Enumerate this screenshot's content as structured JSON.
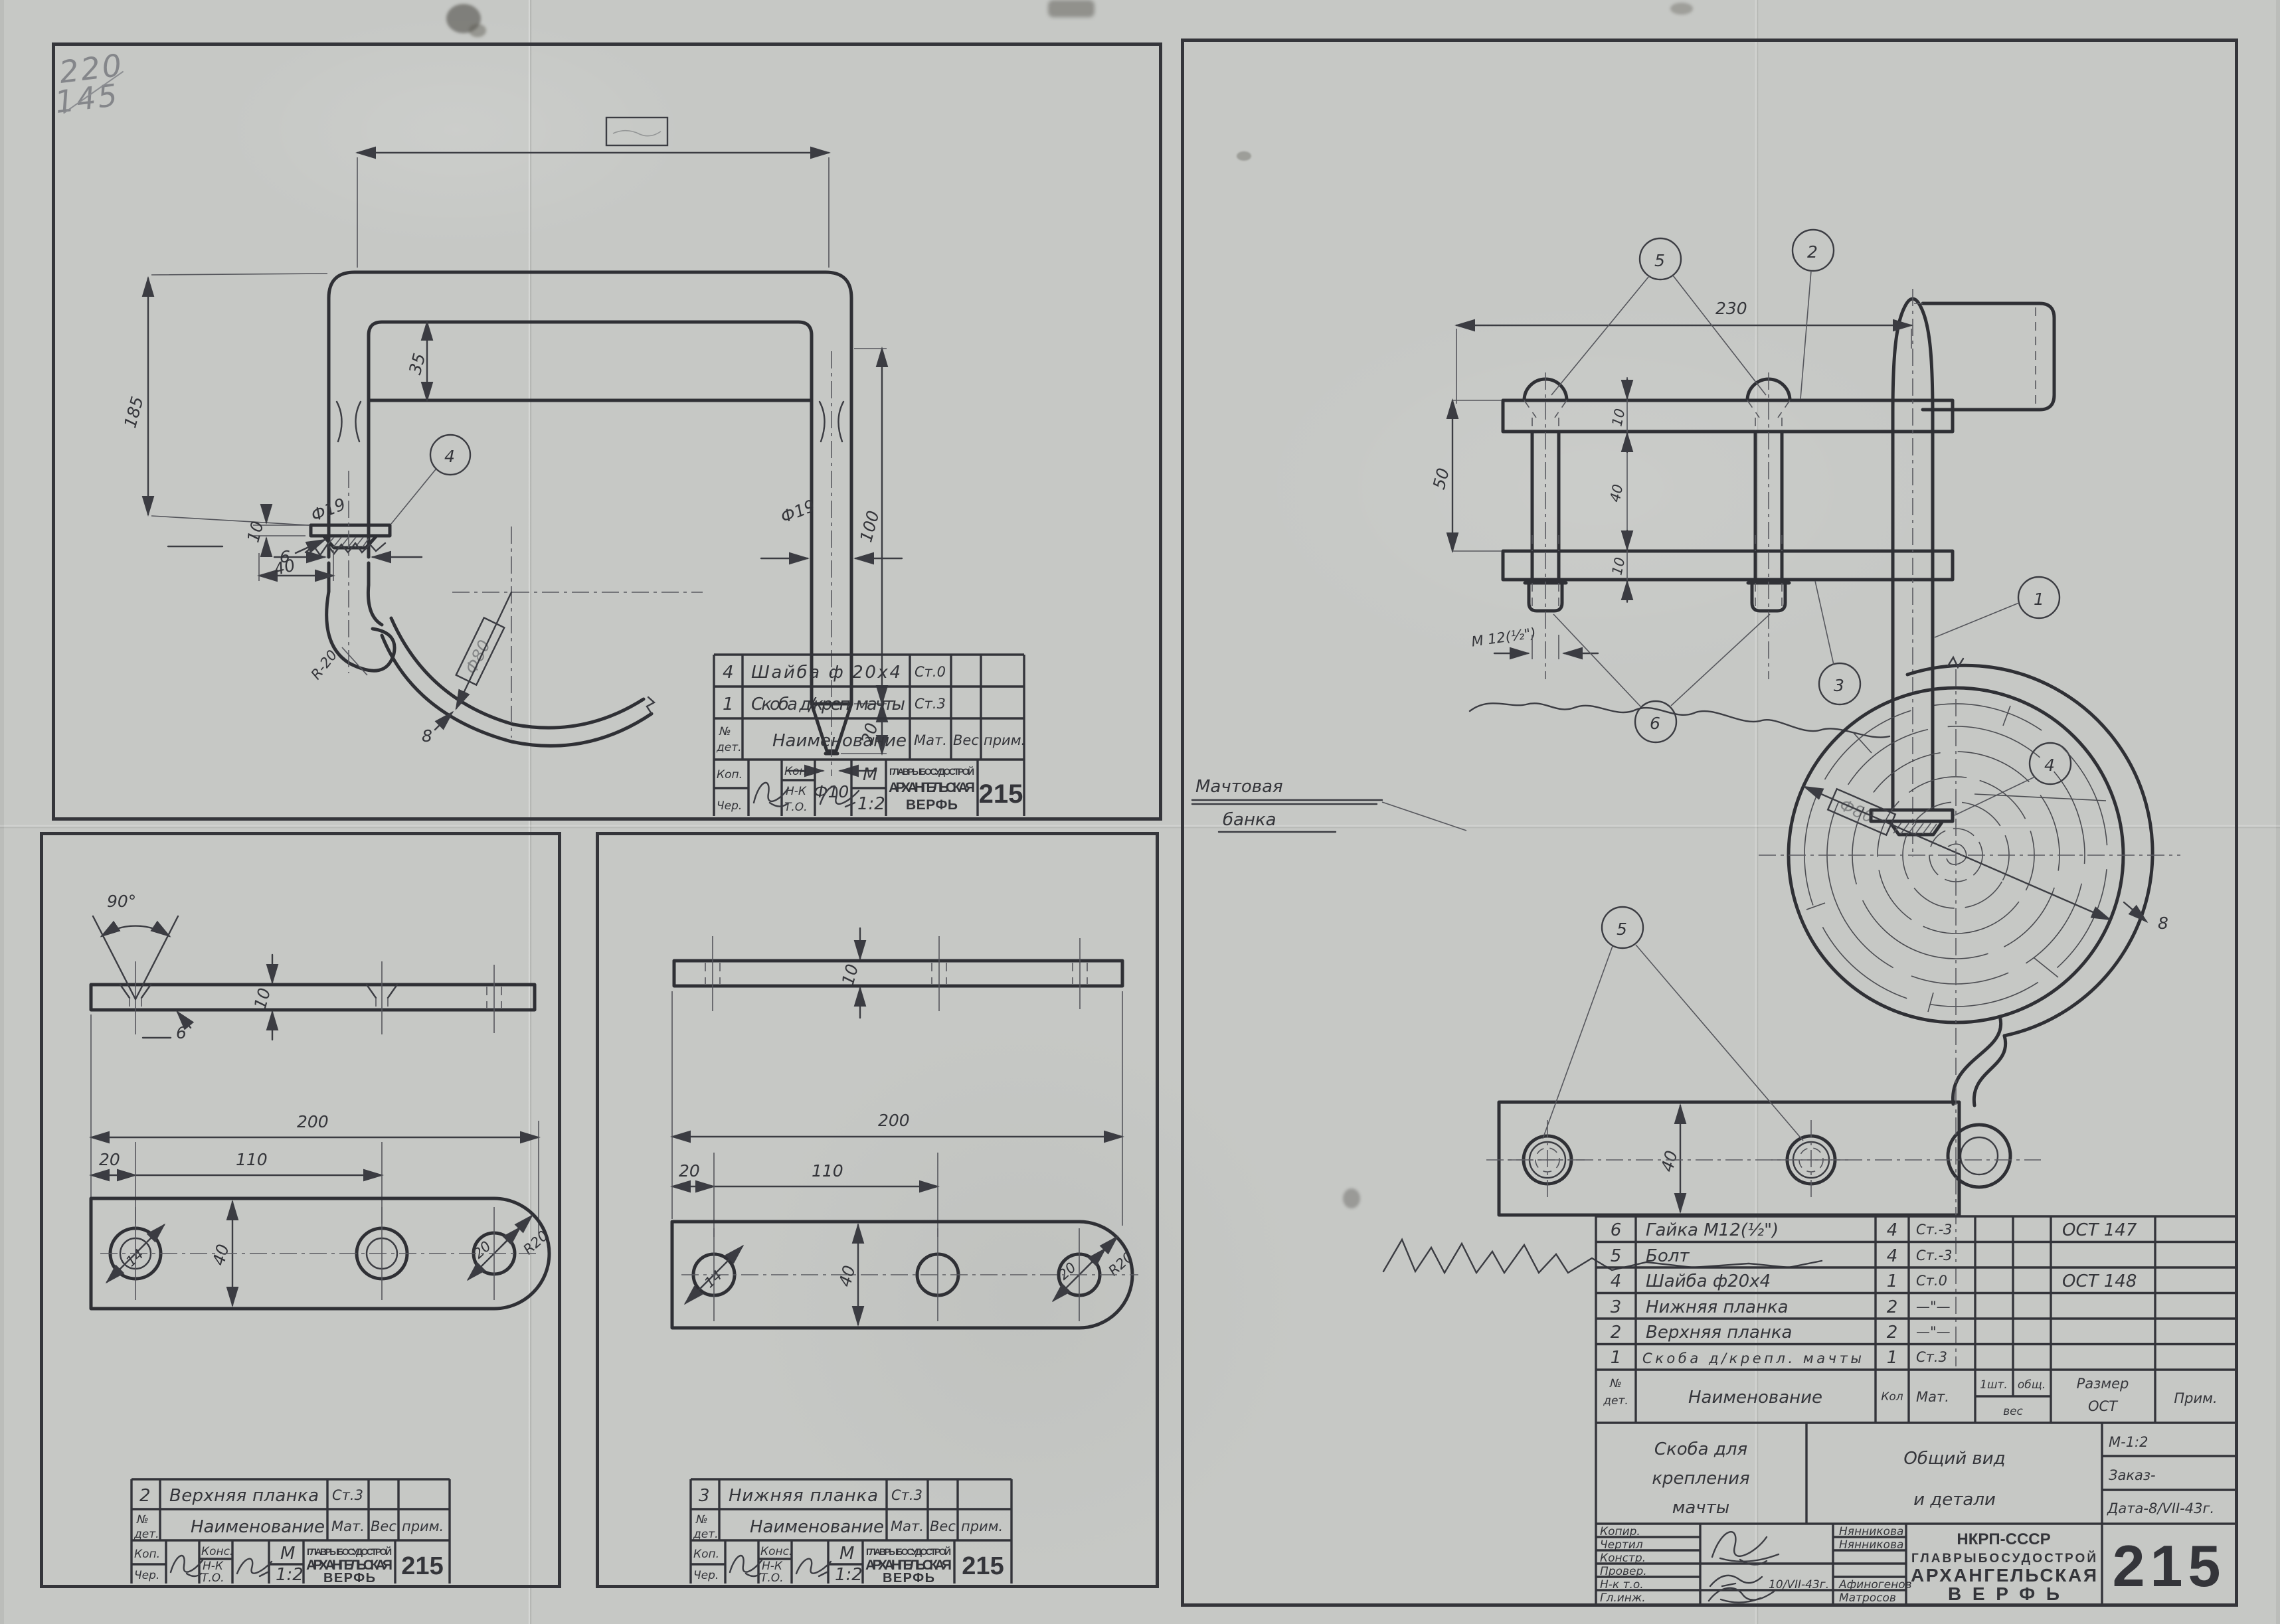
{
  "pencil_note": {
    "line1": "220",
    "line2": "145"
  },
  "small_stamp": {
    "header": {
      "no1": "№",
      "no2": "дет.",
      "name": "Наименование",
      "mat": "Мат.",
      "ves": "Вес",
      "prim": "прим."
    },
    "kop": "Коп.",
    "cher": "Чер.",
    "kon": "Кон.",
    "kons": "Конс.",
    "nk": "Н-К",
    "to": "Т.О.",
    "m": "М",
    "scale": "1:2",
    "org1": "ГЛАВРЫБОСУДОСТРОЙ",
    "org2": "АРХАНГЕЛЬСКАЯ",
    "org3": "ВЕРФЬ",
    "number": "215"
  },
  "tl": {
    "parts": [
      {
        "no": "4",
        "name": "Шайба ф 20х4",
        "mat": "Ст.0"
      },
      {
        "no": "1",
        "name": "Скоба д/креп. мачты",
        "mat": "Ст.3"
      }
    ],
    "balloon4": "4",
    "dims": {
      "span": "",
      "bar": "35",
      "leg": "185",
      "right": "100",
      "tip": "20",
      "tip_dia": "Ф10",
      "dia_l": "Ф19",
      "dia_r": "Ф19",
      "washer": "10",
      "cone": "6",
      "hook_w": "40",
      "hook_r": "R-20",
      "band_dia": "Ф80",
      "band_t": "8"
    }
  },
  "bl": {
    "part": {
      "no": "2",
      "name": "Верхняя планка",
      "mat": "Ст.3"
    },
    "dims": {
      "angle": "90°",
      "t": "10",
      "depth": "6",
      "len": "200",
      "off": "20",
      "pitch": "110",
      "width": "40",
      "hole": "14",
      "end": "20",
      "radius": "R20"
    }
  },
  "bm": {
    "part": {
      "no": "3",
      "name": "Нижняя планка",
      "mat": "Ст.3"
    },
    "dims": {
      "t": "10",
      "len": "200",
      "off": "20",
      "pitch": "110",
      "width": "40",
      "hole": "14",
      "end": "20",
      "radius": "R20"
    }
  },
  "rt": {
    "mast_label1": "Мачтовая",
    "mast_label2": "банка",
    "balloons": {
      "b1": "1",
      "b2": "2",
      "b3": "3",
      "b4": "4",
      "b5": "5",
      "b6": "6"
    },
    "dims": {
      "span": "230",
      "h": "50",
      "t1": "10",
      "gap": "40",
      "t2": "10",
      "thread": "М 12(½\")",
      "width": "40",
      "dia": "Ф80",
      "band": "8"
    },
    "parts": [
      {
        "no": "6",
        "name": "Гайка М12(½\")",
        "qty": "4",
        "mat": "Ст.-3",
        "ost": "ОСТ 147"
      },
      {
        "no": "5",
        "name": "Болт",
        "qty": "4",
        "mat": "Ст.-3",
        "ost": ""
      },
      {
        "no": "4",
        "name": "Шайба ф20х4",
        "qty": "1",
        "mat": "Ст.0",
        "ost": "ОСТ 148"
      },
      {
        "no": "3",
        "name": "Нижняя планка",
        "qty": "2",
        "mat": "—\"—",
        "ost": ""
      },
      {
        "no": "2",
        "name": "Верхняя планка",
        "qty": "2",
        "mat": "—\"—",
        "ost": ""
      },
      {
        "no": "1",
        "name": "Скоба д/крепл. мачты",
        "qty": "1",
        "mat": "Ст.3",
        "ost": ""
      }
    ],
    "pheader": {
      "no1": "№",
      "no2": "дет.",
      "name": "Наименование",
      "qty": "Кол",
      "mat": "Мат.",
      "v1": "1шт.",
      "v2": "общ.",
      "ves": "вес",
      "raz1": "Размер",
      "raz2": "ОСТ",
      "prim": "Прим."
    },
    "title": {
      "n1": "Скоба для",
      "n2": "крепления",
      "n3": "мачты",
      "v1": "Общий вид",
      "v2": "и детали",
      "scale": "М-1:2",
      "order": "Заказ-",
      "date": "Дата-8/VII-43г."
    },
    "roles": {
      "r1": "Копир.",
      "r2": "Чертил",
      "r3": "Констр.",
      "r4": "Провер.",
      "r5": "Н-к т.о.",
      "r6": "Гл.инж.",
      "n1": "Нянникова",
      "n2": "Нянникова",
      "n5": "Афиногенов",
      "n6": "Матросов",
      "date5": "10/VII-43г."
    },
    "org": {
      "l1": "НКРП-СССР",
      "l2": "ГЛАВРЫБОСУДОСТРОЙ",
      "l3": "АРХАНГЕЛЬСКАЯ",
      "l4": "ВЕРФЬ"
    },
    "number": "215"
  }
}
